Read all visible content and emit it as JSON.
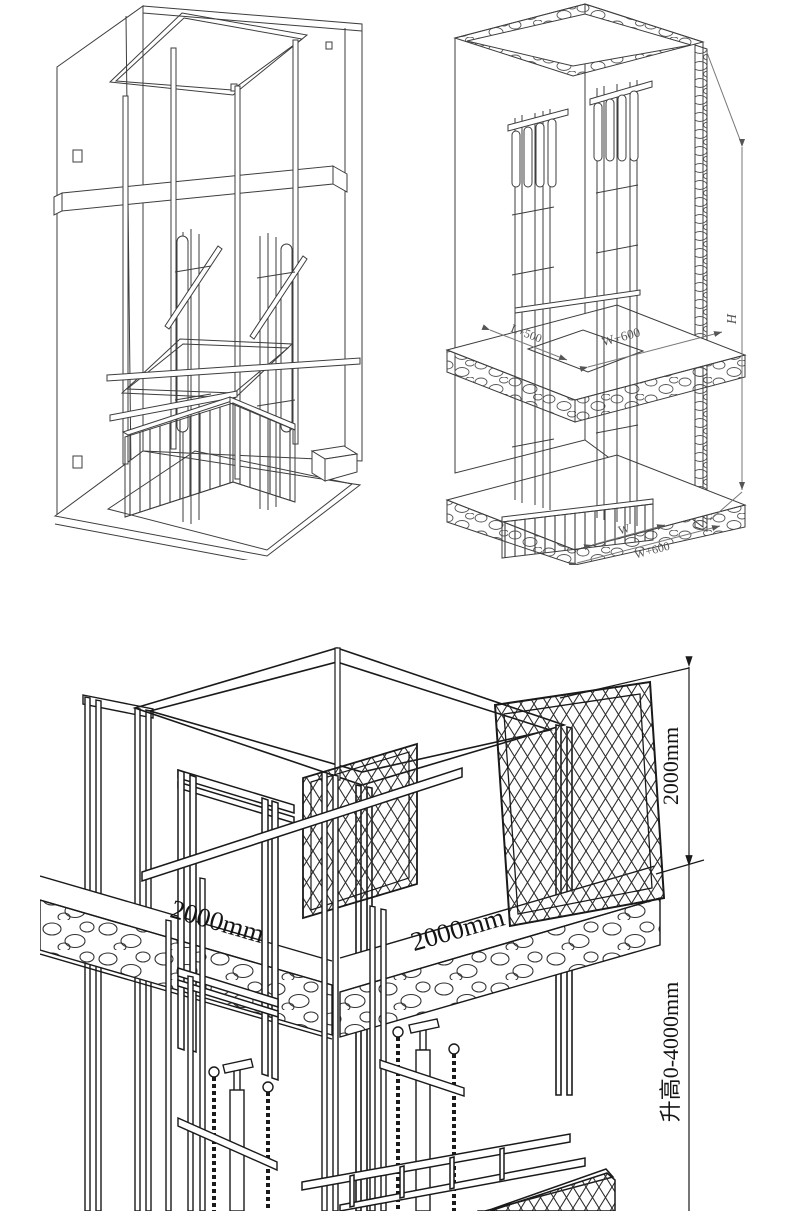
{
  "sheet": {
    "background": "#ffffff"
  },
  "drawings": {
    "wireframe": {
      "name": "isometric wireframe of guide-rail lift cage inside shaft"
    },
    "dimensioned": {
      "labels": {
        "slab_left": "L+500",
        "slab_right": "W+600",
        "height": "H",
        "platform_width": "W",
        "bottom_right": "W+600"
      }
    },
    "detail": {
      "labels": {
        "left_slab": "2000mm",
        "right_slab": "2000mm",
        "floor_spacing": "2000mm",
        "travel": "升高0-4000mm"
      }
    }
  },
  "colors": {
    "line_light": "#3d3d3d",
    "line_dark": "#1a1a1a",
    "dim_gray": "#555555",
    "background": "#ffffff"
  }
}
